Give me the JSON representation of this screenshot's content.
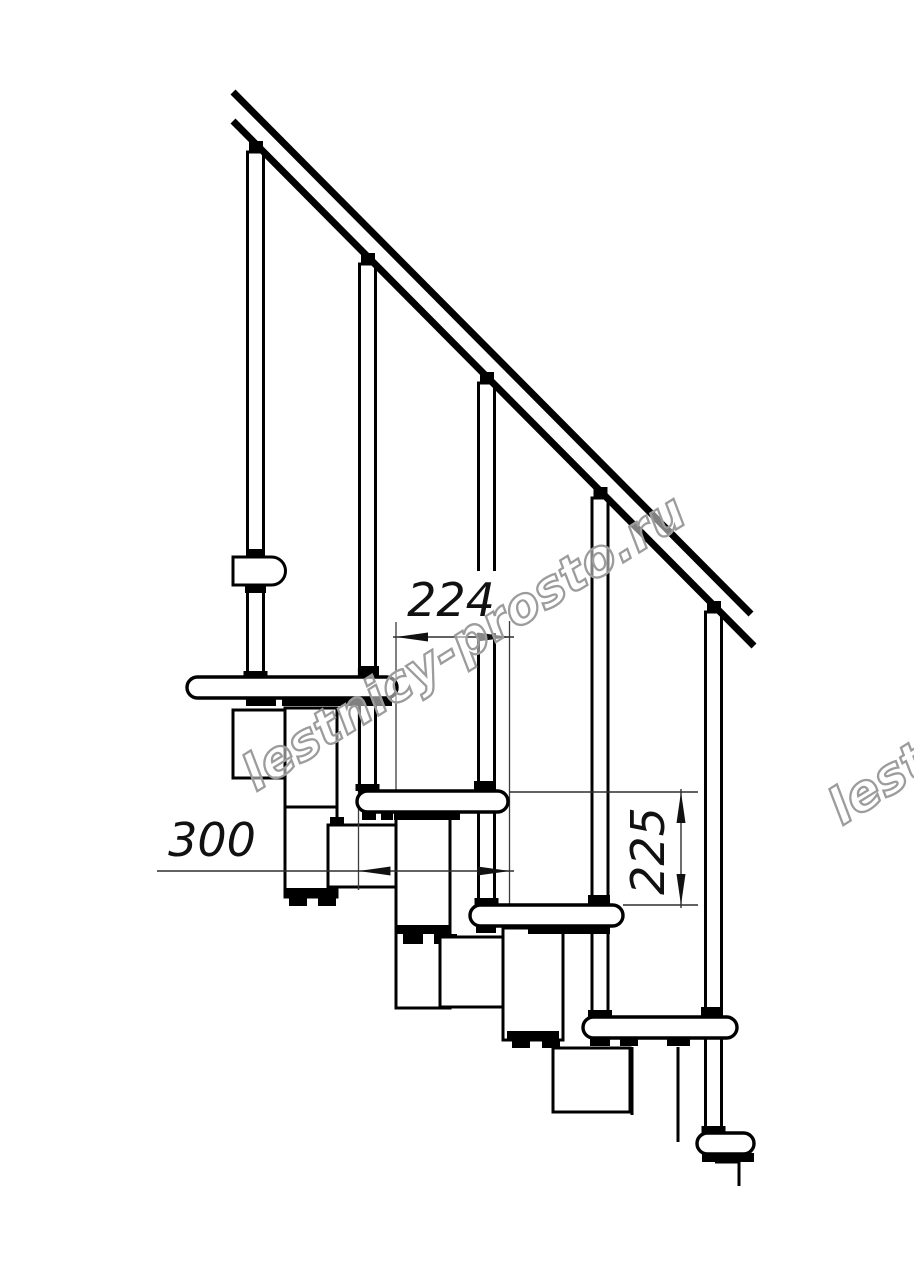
{
  "drawing": {
    "dimensions": {
      "going": "224",
      "tread_length": "300",
      "riser": "225"
    },
    "watermark": {
      "text": "lestnicy-prosto.ru",
      "color": "#9c9c9c"
    },
    "colors": {
      "line": "#000000",
      "dimension_line": "#2f2f2f",
      "background": "#ffffff"
    }
  }
}
